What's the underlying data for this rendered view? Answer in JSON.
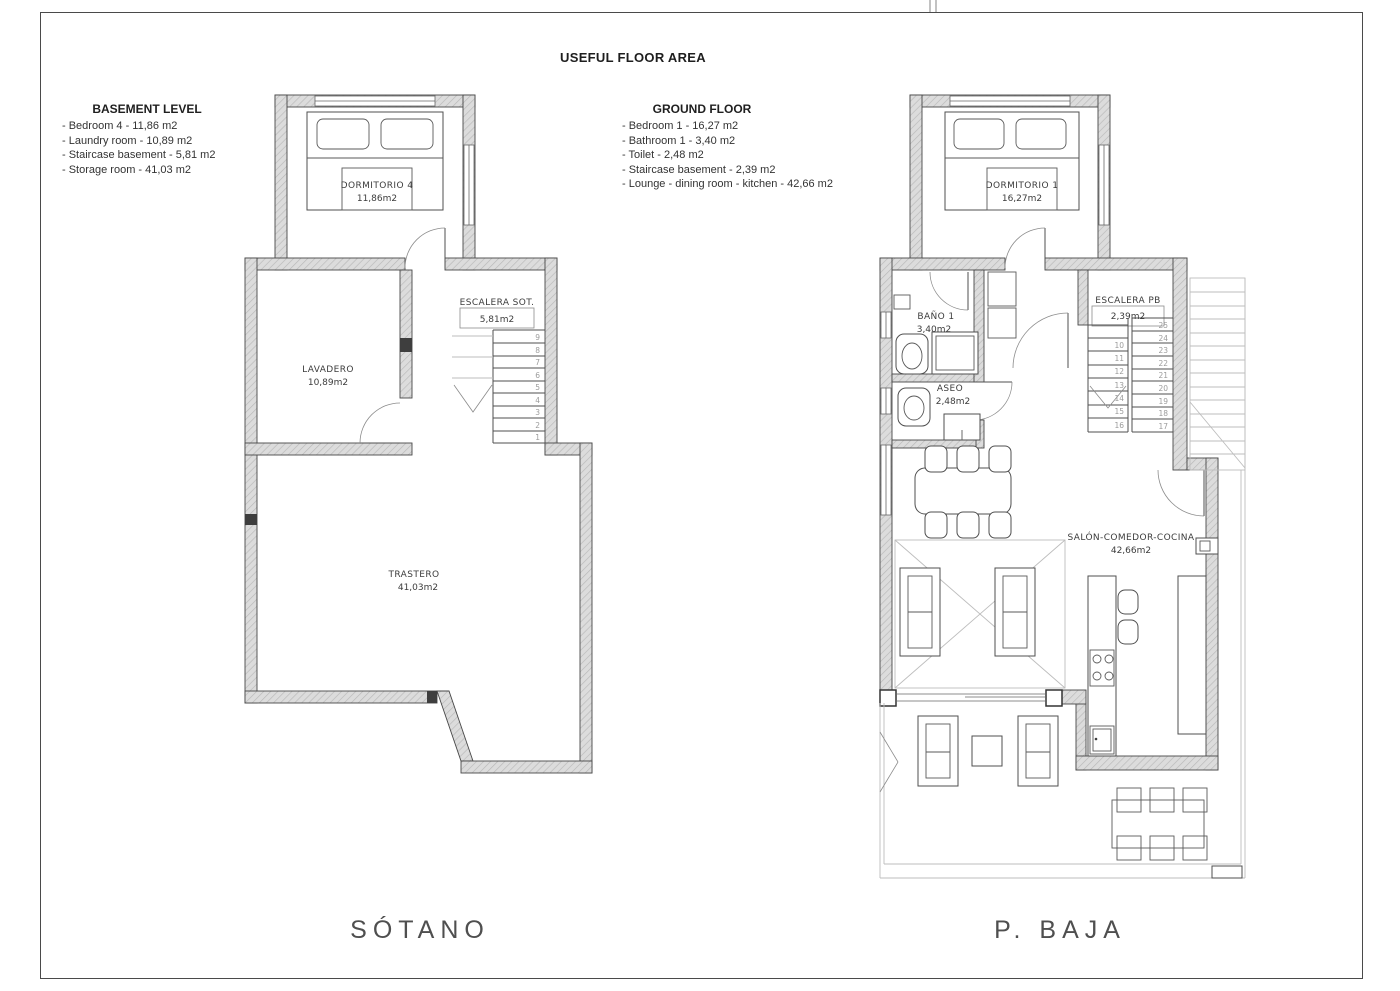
{
  "title": "USEFUL FLOOR AREA",
  "legends": {
    "basement": {
      "heading": "BASEMENT LEVEL",
      "items": [
        "- Bedroom 4 - 11,86 m2",
        "- Laundry room - 10,89 m2",
        "- Staircase basement - 5,81 m2",
        "- Storage room - 41,03 m2"
      ]
    },
    "ground": {
      "heading": "GROUND FLOOR",
      "items": [
        "- Bedroom 1 - 16,27 m2",
        "- Bathroom 1 - 3,40 m2",
        "- Toilet - 2,48 m2",
        "- Staircase basement - 2,39 m2",
        "- Lounge - dining room - kitchen - 42,66 m2"
      ]
    }
  },
  "basement": {
    "caption": "SÓTANO",
    "bedroom": {
      "name": "DORMITORIO 4",
      "area": "11,86m2"
    },
    "laundry": {
      "name": "LAVADERO",
      "area": "10,89m2"
    },
    "staircase": {
      "name": "ESCALERA SOT.",
      "area": "5,81m2"
    },
    "storage": {
      "name": "TRASTERO",
      "area": "41,03m2"
    },
    "stair_numbers": [
      "1",
      "2",
      "3",
      "4",
      "5",
      "6",
      "7",
      "8",
      "9"
    ]
  },
  "ground": {
    "caption": "P. BAJA",
    "bedroom": {
      "name": "DORMITORIO 1",
      "area": "16,27m2"
    },
    "bathroom": {
      "name": "BAÑO 1",
      "area": "3,40m2"
    },
    "toilet": {
      "name": "ASEO",
      "area": "2,48m2"
    },
    "staircase": {
      "name": "ESCALERA PB",
      "area": "2,39m2"
    },
    "lounge": {
      "name": "SALÓN-COMEDOR-COCINA",
      "area": "42,66m2"
    },
    "stair_numbers_lower": [
      "10",
      "11",
      "12",
      "13",
      "14",
      "15",
      "16"
    ],
    "stair_numbers_upper": [
      "25",
      "24",
      "23",
      "22",
      "21",
      "20",
      "19",
      "18",
      "17"
    ]
  },
  "colors": {
    "wall_fill": "#dcdcdc",
    "wall_hatch": "#b8b8b8",
    "wall_stroke": "#474747",
    "drawing_line": "#4f4f4f",
    "light_line": "#bdbdbd",
    "label_text": "#3c3c3c",
    "stair_number_text": "#9c9c9c",
    "caption_text": "#4f4f4f"
  }
}
